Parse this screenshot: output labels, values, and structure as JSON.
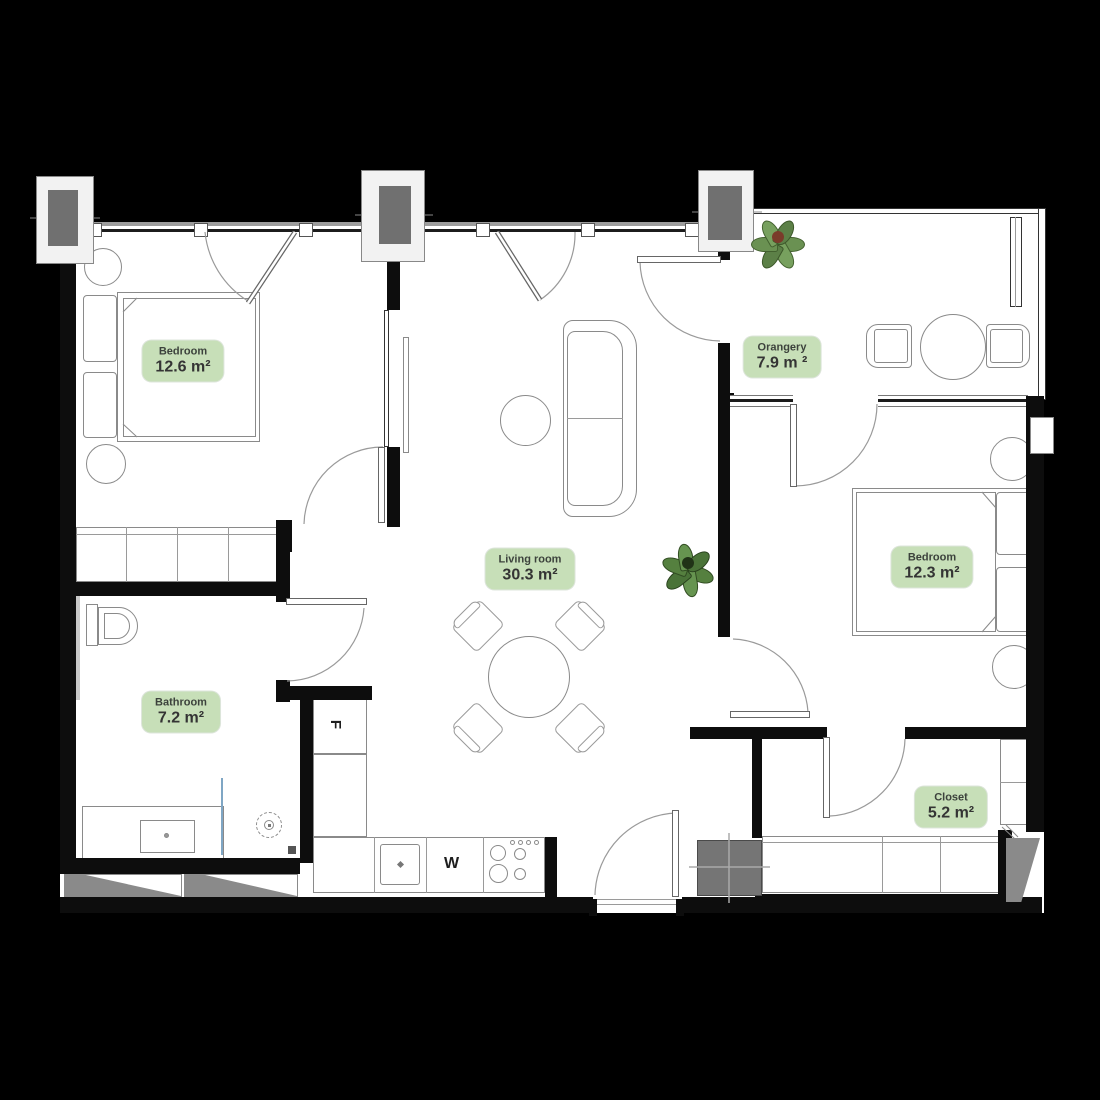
{
  "plan": {
    "rooms": [
      {
        "id": "bedroom-1",
        "name": "Bedroom",
        "area": "12.6 m²"
      },
      {
        "id": "orangery",
        "name": "Orangery",
        "area": "7.9 m ²"
      },
      {
        "id": "living-room",
        "name": "Living room",
        "area": "30.3 m²"
      },
      {
        "id": "bedroom-2",
        "name": "Bedroom",
        "area": "12.3 m²"
      },
      {
        "id": "bathroom",
        "name": "Bathroom",
        "area": "7.2 m²"
      },
      {
        "id": "closet",
        "name": "Closet",
        "area": "5.2 m²"
      }
    ],
    "kitchen": {
      "fridge_label": "F",
      "washer_label": "W"
    },
    "colors": {
      "background": "#000000",
      "floor": "#ffffff",
      "wall": "#0d0d0d",
      "label_bg": "#c7dfb8",
      "label_text": "#3c423c",
      "outline": "#8a8a8a",
      "plant_green": "#6a9152",
      "plant_dark": "#4f7340",
      "shaft_gray": "#757575",
      "glass_blue": "#7fa6c4"
    }
  }
}
